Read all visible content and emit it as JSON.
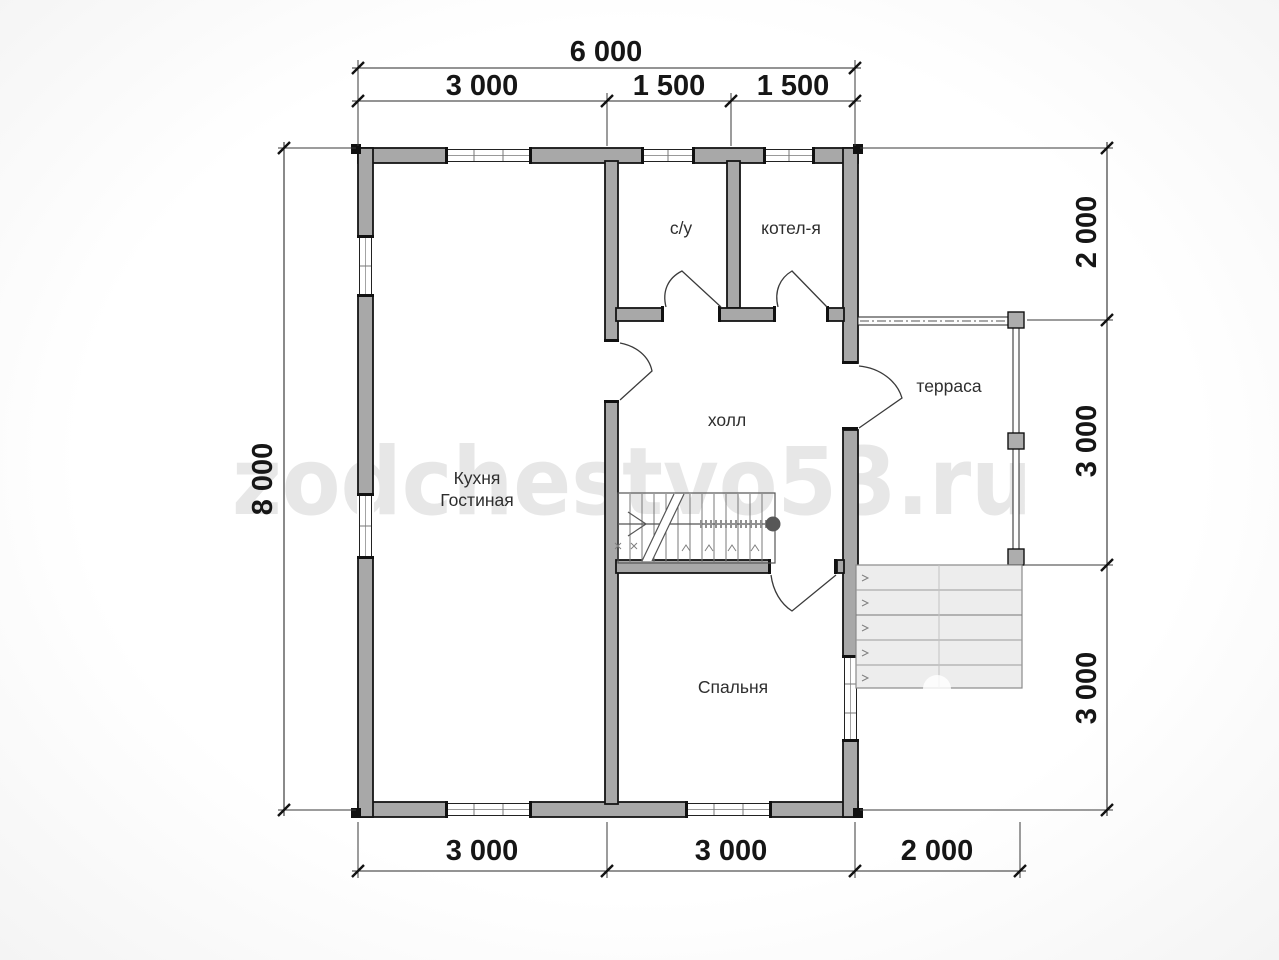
{
  "watermark": {
    "text": "zodchestvo53.ru"
  },
  "dimensions": {
    "top_total": "6 000",
    "top_segments": [
      "3 000",
      "1 500",
      "1 500"
    ],
    "left_total": "8 000",
    "right_segments": [
      "2 000",
      "3 000",
      "3 000"
    ],
    "bottom_segments": [
      "3 000",
      "3 000",
      "2 000"
    ]
  },
  "rooms": {
    "bathroom": "с/у",
    "boiler_room": "котел-я",
    "hall": "холл",
    "kitchen_line1": "Кухня",
    "kitchen_line2": "Гостиная",
    "bedroom": "Спальня",
    "terrace": "терраса"
  }
}
